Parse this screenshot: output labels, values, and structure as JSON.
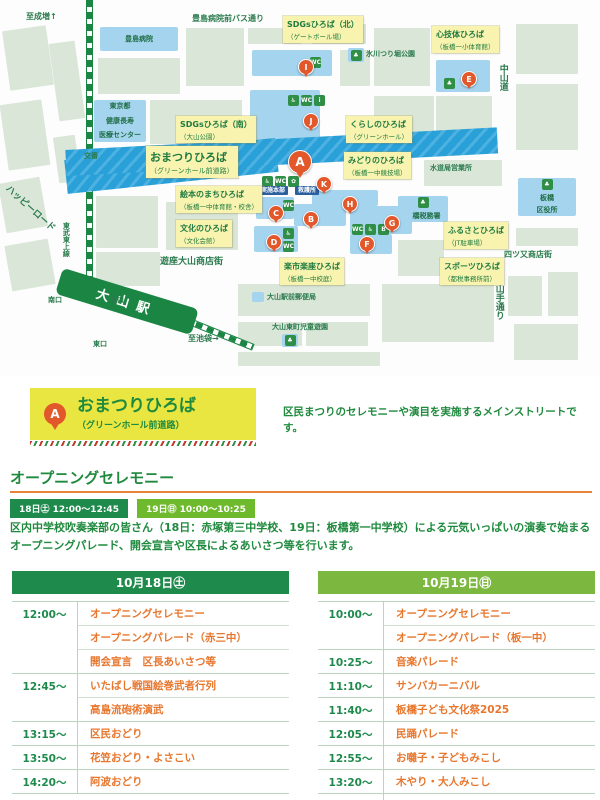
{
  "colors": {
    "green_dark": "#1e8a4c",
    "green_light": "#6fb92c",
    "green_header_light": "#7cb83f",
    "orange_text": "#e8772e",
    "orange_marker": "#e2582b",
    "yellow_card": "#e9e541",
    "yellow_map_label": "#f8f4b0",
    "blue_venue": "#a5d4ee",
    "blue_street": "#2aa0d8",
    "navy_badge": "#2b5f9e",
    "block_green": "#d9e6d8",
    "rule_orange": "#e8833c"
  },
  "map": {
    "station_name": "大山駅",
    "area_labels": [
      {
        "title": "SDGsひろば（北）",
        "subtitle": "（ゲートボール場）",
        "x": 283,
        "y": 16,
        "big": false
      },
      {
        "title": "心技体ひろば",
        "subtitle": "（板橋一小体育館）",
        "x": 432,
        "y": 26,
        "big": false
      },
      {
        "title": "SDGsひろば（南）",
        "subtitle": "（大山公園）",
        "x": 176,
        "y": 116,
        "big": false
      },
      {
        "title": "くらしのひろば",
        "subtitle": "（グリーンホール）",
        "x": 346,
        "y": 116,
        "big": false
      },
      {
        "title": "おまつりひろば",
        "subtitle": "（グリーンホール前道路）",
        "x": 146,
        "y": 146,
        "big": true
      },
      {
        "title": "みどりのひろば",
        "subtitle": "（板橋一中競技場）",
        "x": 344,
        "y": 152,
        "big": false
      },
      {
        "title": "絵本のまちひろば",
        "subtitle": "（板橋一中体育館・校舎）",
        "x": 176,
        "y": 186,
        "big": false
      },
      {
        "title": "文化のひろば",
        "subtitle": "（文化会館）",
        "x": 176,
        "y": 220,
        "big": false
      },
      {
        "title": "楽市楽座ひろば",
        "subtitle": "（板橋一中校庭）",
        "x": 280,
        "y": 258,
        "big": false
      },
      {
        "title": "ふるさとひろば",
        "subtitle": "（JT駐車場）",
        "x": 444,
        "y": 222,
        "big": false
      },
      {
        "title": "スポーツひろば",
        "subtitle": "（都税事務所前）",
        "x": 440,
        "y": 258,
        "big": false
      }
    ],
    "markers": [
      {
        "letter": "A",
        "x": 288,
        "y": 150,
        "big": true
      },
      {
        "letter": "B",
        "x": 303,
        "y": 211,
        "big": false
      },
      {
        "letter": "C",
        "x": 268,
        "y": 205,
        "big": false
      },
      {
        "letter": "D",
        "x": 266,
        "y": 234,
        "big": false
      },
      {
        "letter": "E",
        "x": 461,
        "y": 71,
        "big": false
      },
      {
        "letter": "F",
        "x": 359,
        "y": 236,
        "big": false
      },
      {
        "letter": "G",
        "x": 384,
        "y": 215,
        "big": false
      },
      {
        "letter": "H",
        "x": 342,
        "y": 196,
        "big": false
      },
      {
        "letter": "I",
        "x": 298,
        "y": 59,
        "big": false
      },
      {
        "letter": "J",
        "x": 303,
        "y": 113,
        "big": false
      },
      {
        "letter": "K",
        "x": 316,
        "y": 176,
        "big": false
      }
    ],
    "facilities": [
      {
        "lines": [
          "豊島病院"
        ],
        "icon": "",
        "x": 100,
        "y": 27,
        "w": 78,
        "h": 24
      },
      {
        "lines": [
          "東京都",
          "健康長寿",
          "医療センター"
        ],
        "icon": "",
        "x": 94,
        "y": 100,
        "w": 52,
        "h": 42
      },
      {
        "lines": [
          "板橋",
          "区役所"
        ],
        "icon": "park",
        "x": 518,
        "y": 178,
        "w": 58,
        "h": 38
      },
      {
        "lines": [
          "板橋税務署"
        ],
        "icon": "park",
        "x": 398,
        "y": 196,
        "w": 50,
        "h": 26
      },
      {
        "lines": [],
        "icon": "",
        "x": 252,
        "y": 50,
        "w": 80,
        "h": 26
      },
      {
        "lines": [],
        "icon": "park",
        "x": 348,
        "y": 48,
        "w": 16,
        "h": 14
      },
      {
        "lines": [],
        "icon": "",
        "x": 436,
        "y": 60,
        "w": 54,
        "h": 32
      },
      {
        "lines": [],
        "icon": "",
        "x": 250,
        "y": 90,
        "w": 70,
        "h": 62
      },
      {
        "lines": [],
        "icon": "",
        "x": 256,
        "y": 197,
        "w": 38,
        "h": 22
      },
      {
        "lines": [],
        "icon": "",
        "x": 294,
        "y": 204,
        "w": 52,
        "h": 22
      },
      {
        "lines": [],
        "icon": "",
        "x": 254,
        "y": 226,
        "w": 44,
        "h": 26
      },
      {
        "lines": [],
        "icon": "",
        "x": 312,
        "y": 190,
        "w": 66,
        "h": 16
      },
      {
        "lines": [],
        "icon": "",
        "x": 350,
        "y": 206,
        "w": 62,
        "h": 28
      },
      {
        "lines": [],
        "icon": "",
        "x": 350,
        "y": 234,
        "w": 42,
        "h": 20
      },
      {
        "lines": [],
        "icon": "",
        "x": 252,
        "y": 292,
        "w": 12,
        "h": 10
      },
      {
        "lines": [],
        "icon": "park",
        "x": 282,
        "y": 334,
        "w": 16,
        "h": 13
      }
    ],
    "road_labels": [
      {
        "t": "至成増↑",
        "x": 26,
        "y": 12,
        "s": 8,
        "v": false,
        "r": 0,
        "badge": false
      },
      {
        "t": "豊島病院前バス通り",
        "x": 192,
        "y": 14,
        "s": 8,
        "v": false,
        "r": 0,
        "badge": false
      },
      {
        "t": "中山道",
        "x": 497,
        "y": 64,
        "s": 9,
        "v": true,
        "r": 0,
        "badge": false
      },
      {
        "t": "氷川つり堀公園",
        "x": 366,
        "y": 50,
        "s": 7,
        "v": false,
        "r": 0,
        "badge": false
      },
      {
        "t": "水道局営業所",
        "x": 430,
        "y": 164,
        "s": 7,
        "v": false,
        "r": 0,
        "badge": false
      },
      {
        "t": "四ツ又商店街",
        "x": 504,
        "y": 250,
        "s": 8,
        "v": false,
        "r": 0,
        "badge": false
      },
      {
        "t": "山手通り",
        "x": 493,
        "y": 284,
        "s": 9,
        "v": true,
        "r": 0,
        "badge": false
      },
      {
        "t": "遊座大山商店街",
        "x": 160,
        "y": 257,
        "s": 9,
        "v": false,
        "r": 0,
        "badge": false
      },
      {
        "t": "交番",
        "x": 84,
        "y": 152,
        "s": 7,
        "v": false,
        "r": 0,
        "badge": false
      },
      {
        "t": "ハッピーロード",
        "x": 10,
        "y": 184,
        "s": 9,
        "v": false,
        "r": 42,
        "badge": false
      },
      {
        "t": "東武東上線",
        "x": 62,
        "y": 222,
        "s": 7,
        "v": true,
        "r": 0,
        "badge": false
      },
      {
        "t": "南口",
        "x": 48,
        "y": 296,
        "s": 7,
        "v": false,
        "r": 0,
        "badge": false
      },
      {
        "t": "北口",
        "x": 110,
        "y": 296,
        "s": 7,
        "v": false,
        "r": 0,
        "badge": false
      },
      {
        "t": "東口",
        "x": 93,
        "y": 340,
        "s": 7,
        "v": false,
        "r": 0,
        "badge": false
      },
      {
        "t": "至池袋→",
        "x": 188,
        "y": 334,
        "s": 8,
        "v": false,
        "r": 0,
        "badge": false
      },
      {
        "t": "大山駅前郵便局",
        "x": 267,
        "y": 293,
        "s": 7,
        "v": false,
        "r": 0,
        "badge": false
      },
      {
        "t": "大山東町児童遊園",
        "x": 272,
        "y": 323,
        "s": 7,
        "v": false,
        "r": 0,
        "badge": false
      },
      {
        "t": "実施本部",
        "x": 258,
        "y": 186,
        "s": 6,
        "v": false,
        "r": 0,
        "badge": true
      },
      {
        "t": "救護所",
        "x": 295,
        "y": 186,
        "s": 6,
        "v": false,
        "r": 0,
        "badge": true
      }
    ],
    "icon_chips": [
      {
        "icon": "restroom",
        "x": 310,
        "y": 57
      },
      {
        "icon": "wheelchair",
        "x": 288,
        "y": 95
      },
      {
        "icon": "restroom",
        "x": 301,
        "y": 95
      },
      {
        "icon": "info",
        "x": 314,
        "y": 95
      },
      {
        "icon": "wheelchair",
        "x": 262,
        "y": 176
      },
      {
        "icon": "restroom",
        "x": 275,
        "y": 176
      },
      {
        "icon": "leaf",
        "x": 288,
        "y": 176
      },
      {
        "icon": "restroom",
        "x": 283,
        "y": 200
      },
      {
        "icon": "wheelchair",
        "x": 283,
        "y": 228
      },
      {
        "icon": "restroom",
        "x": 283,
        "y": 241
      },
      {
        "icon": "restroom",
        "x": 352,
        "y": 224
      },
      {
        "icon": "wheelchair",
        "x": 365,
        "y": 224
      },
      {
        "icon": "bus",
        "x": 378,
        "y": 224
      },
      {
        "icon": "park",
        "x": 444,
        "y": 78
      }
    ],
    "icon_glyphs": {
      "restroom": "WC",
      "wheelchair": "♿",
      "park": "♣",
      "info": "i",
      "leaf": "✿",
      "bus": "B"
    }
  },
  "venue_card": {
    "marker": "A",
    "title": "おまつりひろば",
    "subtitle": "（グリーンホール前道路）",
    "description": "区民まつりのセレモニーや演目を実施するメインストリートです。"
  },
  "opening": {
    "heading": "オープニングセレモニー",
    "badges": [
      {
        "label": "18日㊏ 12:00～12:45",
        "variant": "dark"
      },
      {
        "label": "19日㊐ 10:00～10:25",
        "variant": "light"
      }
    ],
    "description": "区内中学校吹奏楽部の皆さん（18日：赤塚第三中学校、19日：板橋第一中学校）による元気いっぱいの演奏で始まるオープニングパレード、開会宣言や区長によるあいさつ等を行います。"
  },
  "schedules": [
    {
      "date_label": "10月18日㊏",
      "variant": "dark",
      "groups": [
        {
          "time": "12:00～",
          "items": [
            "オープニングセレモニー",
            "オープニングパレード（赤三中）",
            "開会宣言　区長あいさつ等"
          ]
        },
        {
          "time": "12:45～",
          "items": [
            "いたばし戦国絵巻武者行列",
            "高島流砲術演武"
          ]
        },
        {
          "time": "13:15～",
          "items": [
            "区民おどり"
          ]
        },
        {
          "time": "13:50～",
          "items": [
            "花笠おどり・よさこい"
          ]
        },
        {
          "time": "14:20～",
          "items": [
            "阿波おどり"
          ]
        }
      ]
    },
    {
      "date_label": "10月19日㊐",
      "variant": "light",
      "groups": [
        {
          "time": "10:00～",
          "items": [
            "オープニングセレモニー",
            "オープニングパレード（板一中）"
          ]
        },
        {
          "time": "10:25～",
          "items": [
            "音楽パレード"
          ]
        },
        {
          "time": "11:10～",
          "items": [
            "サンバカーニバル"
          ]
        },
        {
          "time": "11:40～",
          "items": [
            "板橋子ども文化祭2025"
          ]
        },
        {
          "time": "12:05～",
          "items": [
            "民踊パレード"
          ]
        },
        {
          "time": "12:55～",
          "items": [
            "お囃子・子どもみこし"
          ]
        },
        {
          "time": "13:20～",
          "items": [
            "木やり・大人みこし"
          ]
        },
        {
          "time": "16:00～",
          "items": [
            "区長あいさつ"
          ]
        }
      ]
    }
  ]
}
